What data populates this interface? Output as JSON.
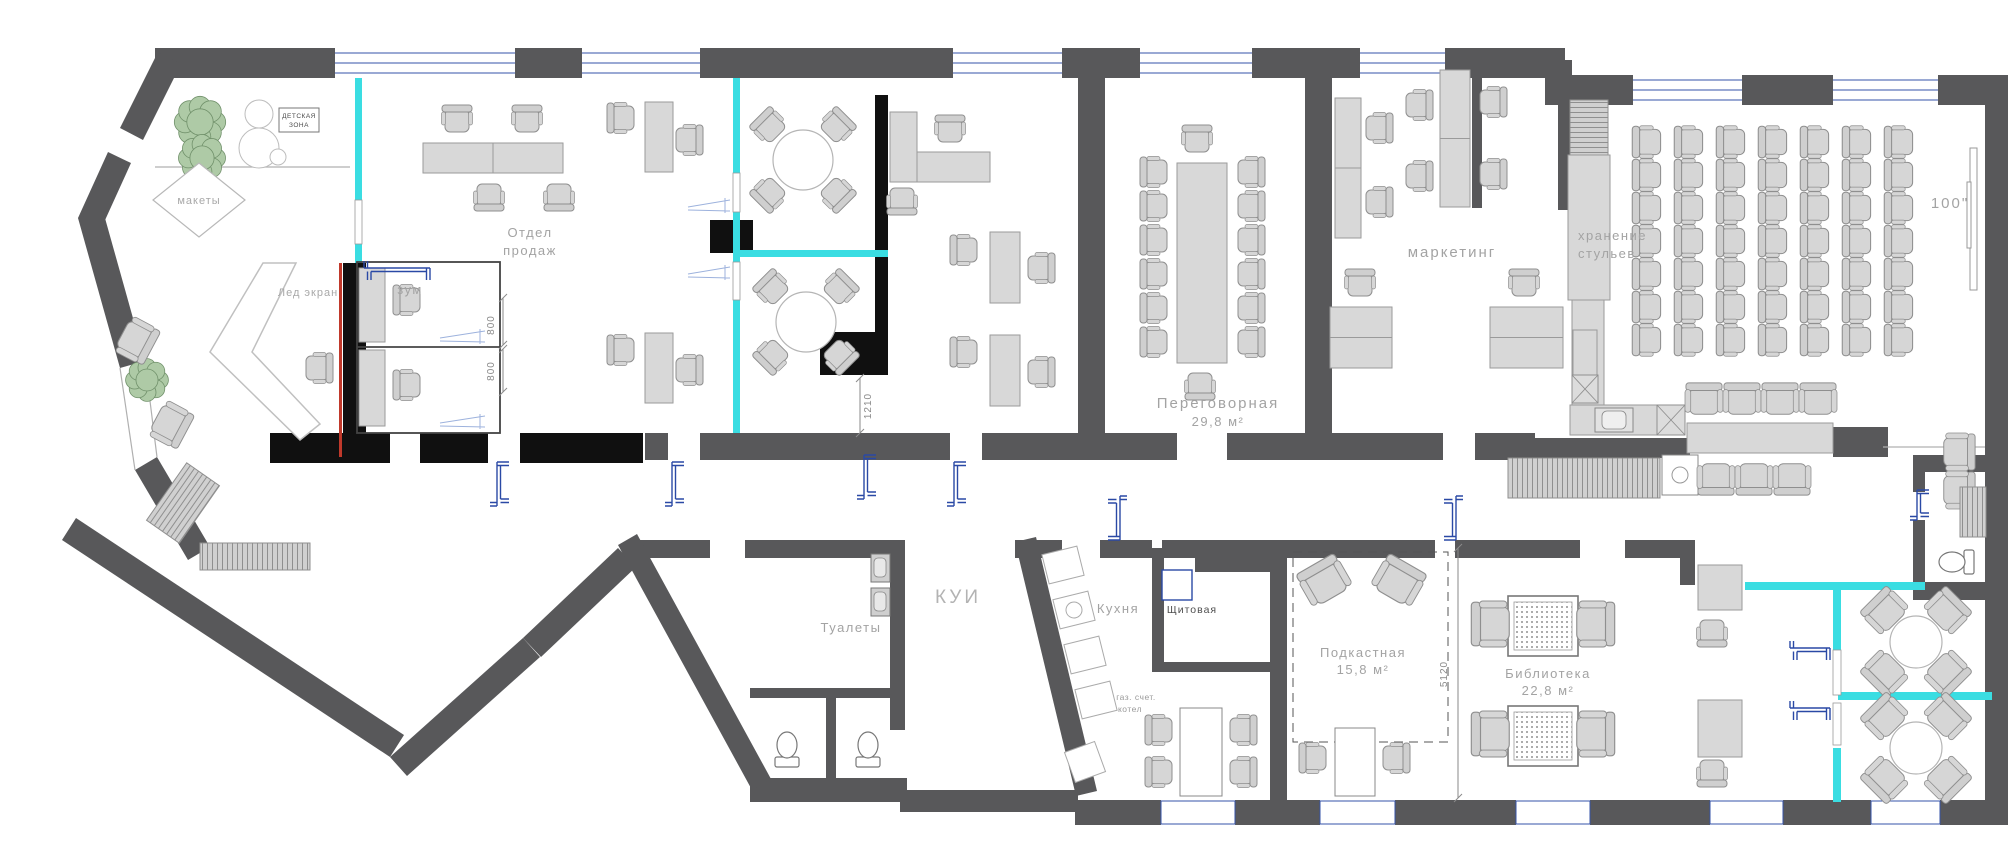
{
  "title": "Office floor plan",
  "rooms": {
    "kids": {
      "line1": "ДЕТСКАЯ",
      "line2": "ЗОНА"
    },
    "maketi": {
      "name": "макеты"
    },
    "led": {
      "name": "Лед экран"
    },
    "zoom": {
      "name": "зум"
    },
    "sales": {
      "line1": "Отдел",
      "line2": "продаж"
    },
    "meeting": {
      "name": "Переговорная",
      "area": "29,8 м²"
    },
    "marketing": {
      "name": "маркетинг"
    },
    "storage": {
      "line1": "хранение",
      "line2": "стульев"
    },
    "toilets": {
      "name": "Туалеты"
    },
    "kui": {
      "name": "КУИ"
    },
    "kitchen": {
      "name": "Кухня"
    },
    "electrical": {
      "name": "Щитовая"
    },
    "gas": {
      "line1": "газ. счет.",
      "line2": "котел"
    },
    "podcast": {
      "name": "Подкастная",
      "area": "15,8 м²"
    },
    "library": {
      "name": "Библиотека",
      "area": "22,8 м²"
    }
  },
  "annotations": {
    "screen_size": "100\"",
    "dim_800a": "800",
    "dim_800b": "800",
    "dim_1210": "1210",
    "dim_5120": "5120"
  },
  "colors": {
    "wall": "#58585a",
    "wall_black": "#101010",
    "glass": "#3adde2",
    "door_blue": "#2a49a5",
    "door_light": "#9db2dd",
    "window_line": "#3653a8",
    "furniture_fill": "#d6d6d6",
    "furniture_stroke": "#8f8f8f",
    "desk_fill": "#d8d8d8",
    "plant_fill": "#aecaa6",
    "plant_stroke": "#71916b",
    "accent_red": "#c0392b",
    "label_gray": "#a3a3a3"
  }
}
